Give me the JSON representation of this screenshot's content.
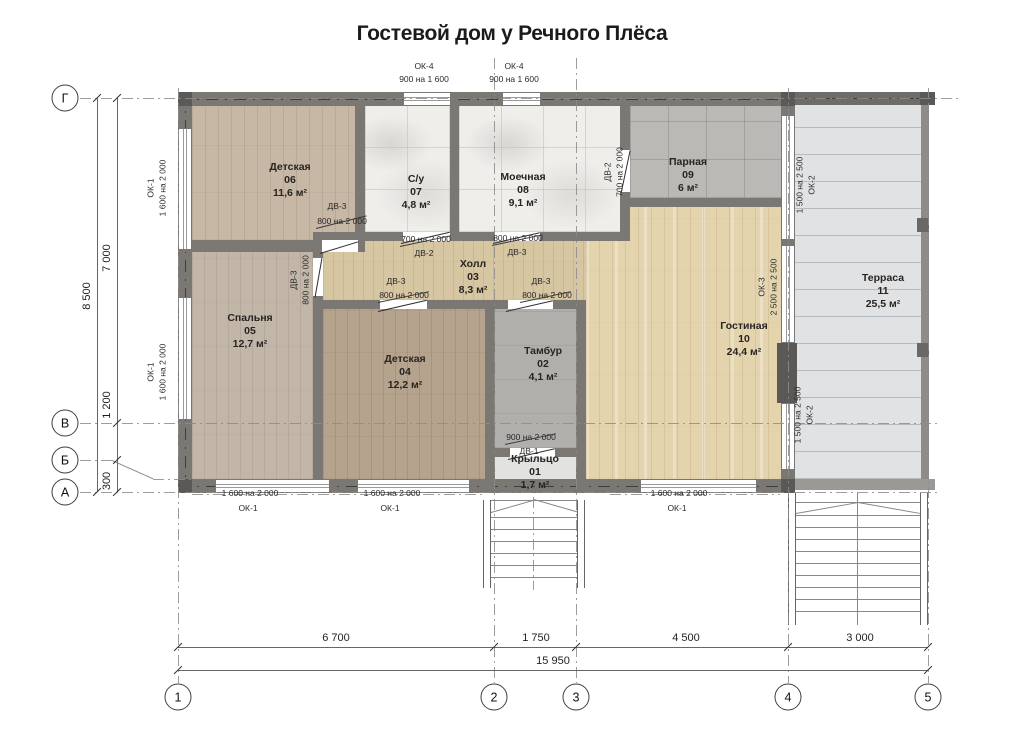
{
  "title": "Гостевой дом у Речного Плёса",
  "rooms": [
    {
      "name": "Крыльцо",
      "number": "01",
      "area": "1,7 м²"
    },
    {
      "name": "Тамбур",
      "number": "02",
      "area": "4,1 м²"
    },
    {
      "name": "Холл",
      "number": "03",
      "area": "8,3 м²"
    },
    {
      "name": "Детская",
      "number": "04",
      "area": "12,2 м²"
    },
    {
      "name": "Спальня",
      "number": "05",
      "area": "12,7 м²"
    },
    {
      "name": "Детская",
      "number": "06",
      "area": "11,6 м²"
    },
    {
      "name": "С/у",
      "number": "07",
      "area": "4,8 м²"
    },
    {
      "name": "Моечная",
      "number": "08",
      "area": "9,1 м²"
    },
    {
      "name": "Парная",
      "number": "09",
      "area": "6 м²"
    },
    {
      "name": "Гостиная",
      "number": "10",
      "area": "24,4 м²"
    },
    {
      "name": "Терраса",
      "number": "11",
      "area": "25,5 м²"
    }
  ],
  "openings": {
    "ok1": {
      "label": "ОК-1",
      "size": "1 600 на 2 000"
    },
    "ok2": {
      "label": "ОК-2",
      "size": "1 500 на 2 500"
    },
    "ok3": {
      "label": "ОК-3",
      "size": "2 500 на 2 500"
    },
    "ok4": {
      "label": "ОК-4",
      "size": "900 на 1 600"
    },
    "dv1": {
      "label": "ДВ-1",
      "size": "900 на 2 000"
    },
    "dv2": {
      "label": "ДВ-2",
      "size": "700 на 2 000"
    },
    "dv3": {
      "label": "ДВ-3",
      "size": "800 на 2 000"
    }
  },
  "axes": {
    "rows": [
      "Г",
      "В",
      "Б",
      "А"
    ],
    "cols": [
      "1",
      "2",
      "3",
      "4",
      "5"
    ]
  },
  "dimensions": {
    "left_total": "8 500",
    "left_segments": [
      "7 000",
      "1 200",
      "300"
    ],
    "bottom_segments": [
      "6 700",
      "1 750",
      "4 500",
      "3 000"
    ],
    "bottom_total": "15 950"
  },
  "colors": {
    "wall": "#7b7874",
    "wall_dark": "#5b5855",
    "wood_living": "#e4d4ae",
    "wood_room": "#c7b7a5",
    "tile_white": "#efeeeb",
    "tile_sauna": "#bbb9b5",
    "terrace": "#e0e2e4"
  }
}
